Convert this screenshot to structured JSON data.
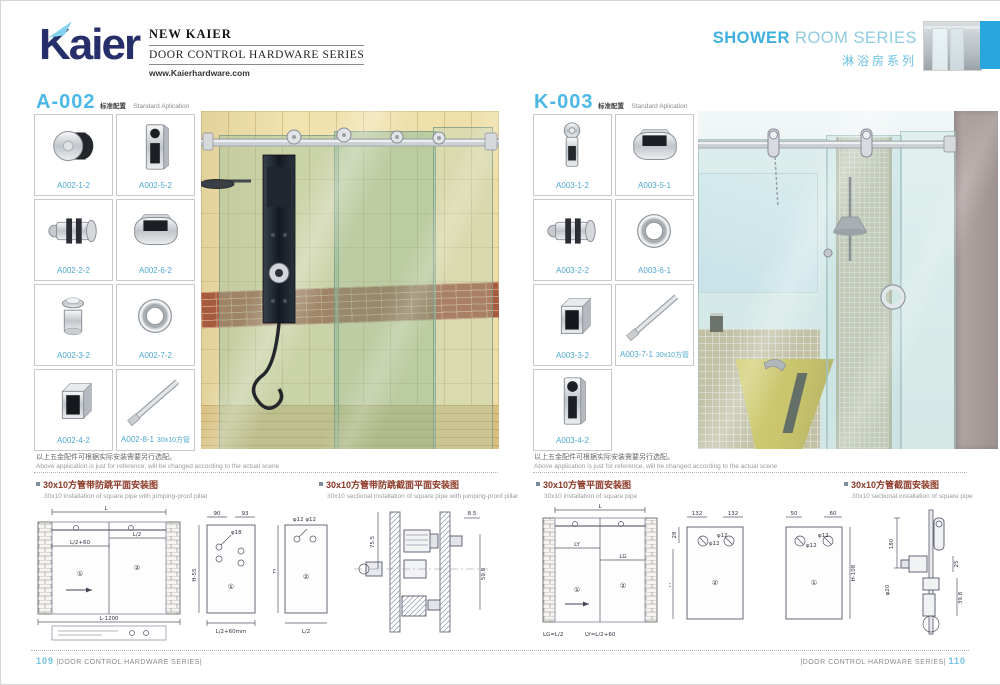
{
  "header": {
    "logo_text": "Kaier",
    "brand_title": "NEW KAIER",
    "brand_subtitle": "DOOR CONTROL HARDWARE SERIES",
    "website": "www.Kaierhardware.com",
    "series_en_bold": "SHOWER",
    "series_en_rest": " ROOM SERIES",
    "series_cn": "淋浴房系列",
    "accent_bar_color": "#28a7de"
  },
  "left_page": {
    "code": "A-002",
    "standard_cn": "标准配置",
    "standard_en": "Standard Aplication",
    "products": [
      {
        "code": "A002-1-2"
      },
      {
        "code": "A002-5-2"
      },
      {
        "code": "A002-2-2"
      },
      {
        "code": "A002-6-2"
      },
      {
        "code": "A002-3-2"
      },
      {
        "code": "A002-7-2"
      },
      {
        "code": "A002-4-2"
      },
      {
        "code": "A002-8-1",
        "note": "30x10方管"
      }
    ],
    "disclaimer_cn": "以上五金配件可根据实际安装需要另行选配。",
    "disclaimer_en": "Above application is just for reference, will be changed according to the actual scene",
    "caption1_cn": "30x10方管带防跳平面安装图",
    "caption1_en": "30x10 installation of square pipe with jumping-proof pillar",
    "caption2_cn": "30x10方管带防跳截面平面安装图",
    "caption2_en": "30x10 sectional installation of square pipe with jumping-proof pillar",
    "footer_page": "109",
    "footer_text": "|DOOR CONTROL HARDWARE SERIES|"
  },
  "right_page": {
    "code": "K-003",
    "standard_cn": "标准配置",
    "standard_en": "Standard Aplication",
    "products": [
      {
        "code": "A003-1-2"
      },
      {
        "code": "A003-5-1"
      },
      {
        "code": "A003-2-2"
      },
      {
        "code": "A003-6-1"
      },
      {
        "code": "A003-3-2"
      },
      {
        "code": "A003-7-1",
        "note": "30x10方管"
      },
      {
        "code": "A003-4-2"
      }
    ],
    "disclaimer_cn": "以上五金配件可根据实际安装需要另行选配。",
    "disclaimer_en": "Above application is just for reference, will be changed according to the actual scene",
    "caption1_cn": "30x10方管平面安装图",
    "caption1_en": "30x10 installation of square pipe",
    "caption2_cn": "30x10方管截面安装图",
    "caption2_en": "30x10 sectional installation of square pipe",
    "footer_page": "110",
    "footer_text": "|DOOR CONTROL HARDWARE SERIES|"
  },
  "drawings": {
    "left_elevation": {
      "dim_top": "L",
      "dim_p1": "L/2+60",
      "dim_p2": "L/2",
      "dim_bottom": "L-1200",
      "panel1": "①",
      "panel2": "②"
    },
    "left_panel_a": {
      "dim_a": "90",
      "dim_b": "93",
      "hole": "φ18",
      "dim_h": "H-55",
      "dim_bottom": "L/2+60mm",
      "panel": "①"
    },
    "left_panel_b": {
      "hole": "φ12  φ12",
      "dim_h": "H",
      "dim_bottom": "L/2",
      "panel": "②"
    },
    "left_section": {
      "dim_a": "75.5",
      "dim_b": "8.5",
      "dim_c": "59.8"
    },
    "right_elevation": {
      "dim_top": "L",
      "dim_p1": "LY",
      "dim_p2": "LG",
      "panel1": "①",
      "panel2": "②",
      "formula_a": "LG=L/2",
      "formula_b": "LY=L/2+60"
    },
    "right_panel_a": {
      "dim_a": "132",
      "dim_b": "132",
      "hole_a": "φ12",
      "hole_b": "φ12",
      "dim_h": "H",
      "dim_s": "28",
      "panel": "②"
    },
    "right_panel_b": {
      "dim_a": "50",
      "dim_b": "60",
      "hole_a": "φ12",
      "hole_b": "φ12",
      "dim_h": "H-108",
      "panel": "①"
    },
    "right_section": {
      "dim_a": "180",
      "dim_b": "25",
      "dim_c": "39.8",
      "dim_d": "φ20"
    }
  }
}
